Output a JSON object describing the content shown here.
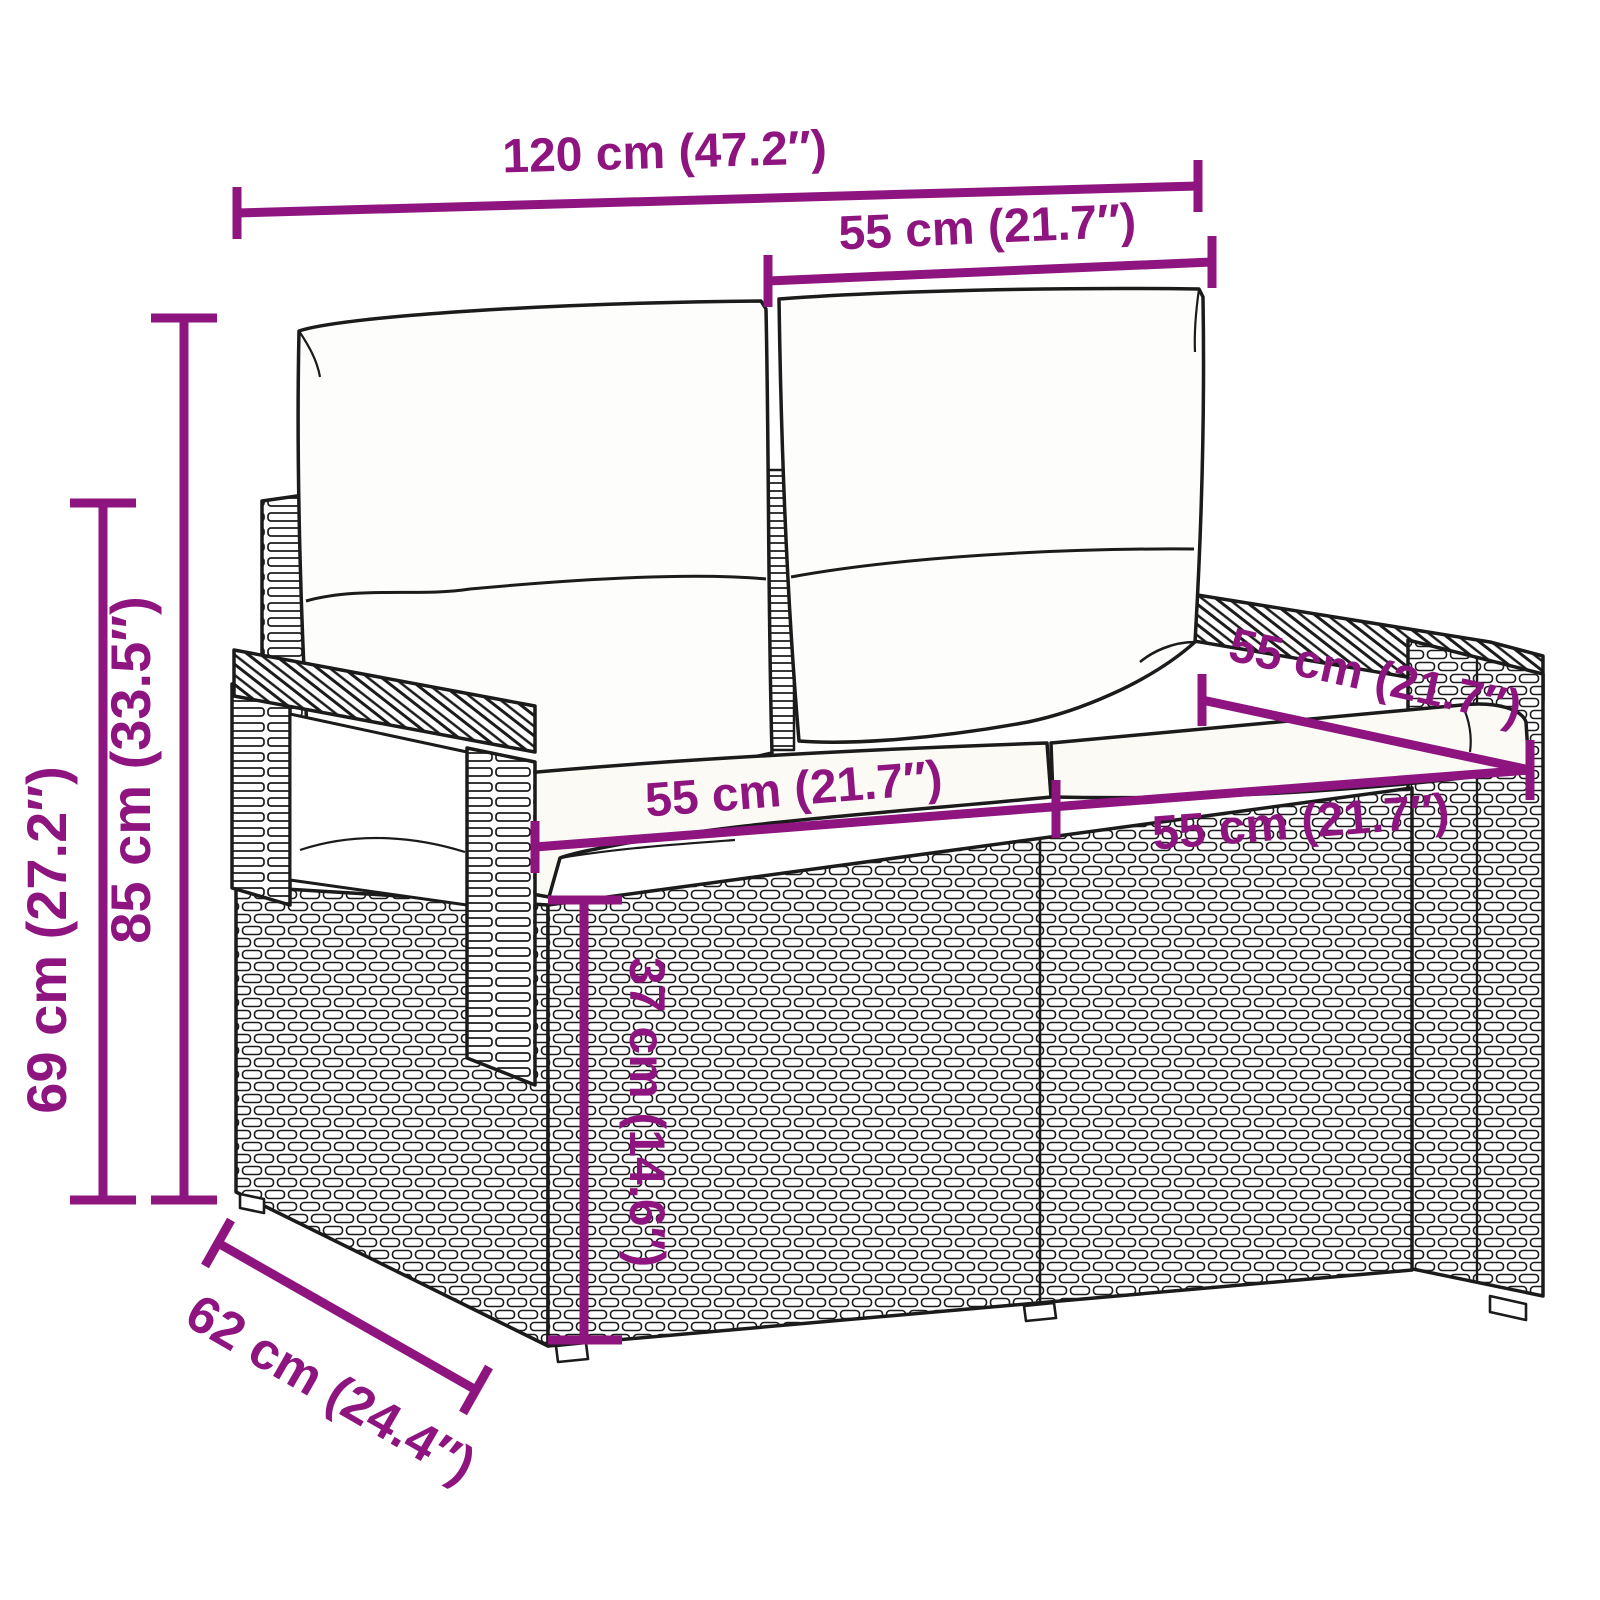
{
  "accent_color": "#8E1480",
  "outline_color": "#1b1b1b",
  "diagram": {
    "subject": "two-seater poly rattan garden bench with back and seat cushions",
    "view": "three-quarter perspective line drawing with dimension annotations"
  },
  "dimensions": {
    "overall_width": "120 cm (47.2″)",
    "back_cushion_width": "55 cm (21.7″)",
    "overall_height": "85 cm (33.5″)",
    "armrest_height": "69 cm (27.2″)",
    "seat_depth": "55 cm (21.7″)",
    "seat_width_left": "55 cm (21.7″)",
    "seat_width_right": "55 cm (21.7″)",
    "seat_height": "37 cm (14.6″)",
    "overall_depth": "62 cm (24.4″)"
  }
}
